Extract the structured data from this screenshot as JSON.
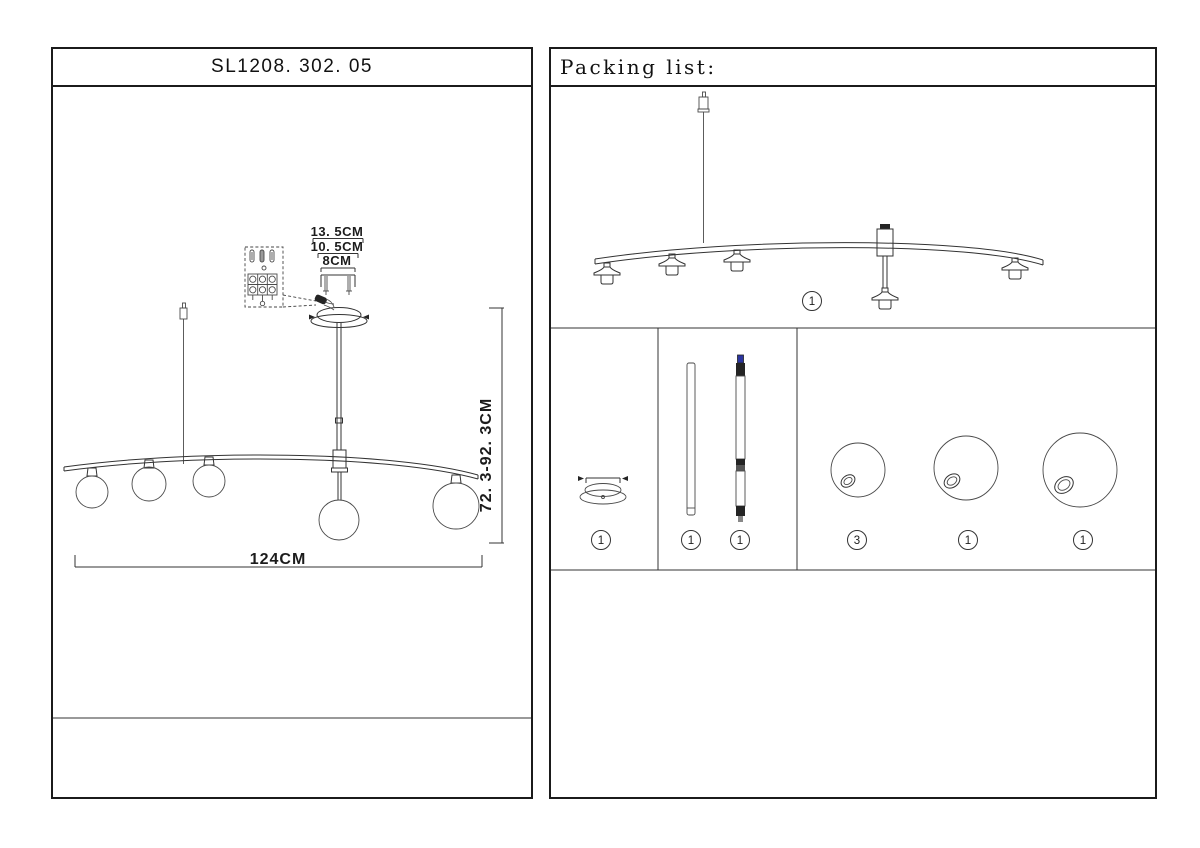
{
  "page": {
    "background": "#ffffff"
  },
  "left_panel": {
    "title": "SL1208. 302. 05",
    "dims": {
      "canopy_outer": "13. 5CM",
      "canopy_inner": "10. 5CM",
      "screw_pitch": "8CM",
      "fixture_length": "124CM",
      "drop_height": "72. 3-92. 3CM"
    }
  },
  "right_panel": {
    "title": "Packing list:",
    "quantities": {
      "bar_assembly": "1",
      "canopy": "1",
      "rod_plain": "1",
      "rod_connector": "1",
      "globe_small": "3",
      "globe_medium": "1",
      "globe_large": "1"
    }
  },
  "colors": {
    "ink": "#2a2a2a",
    "blue_connector": "#2b35a0"
  }
}
